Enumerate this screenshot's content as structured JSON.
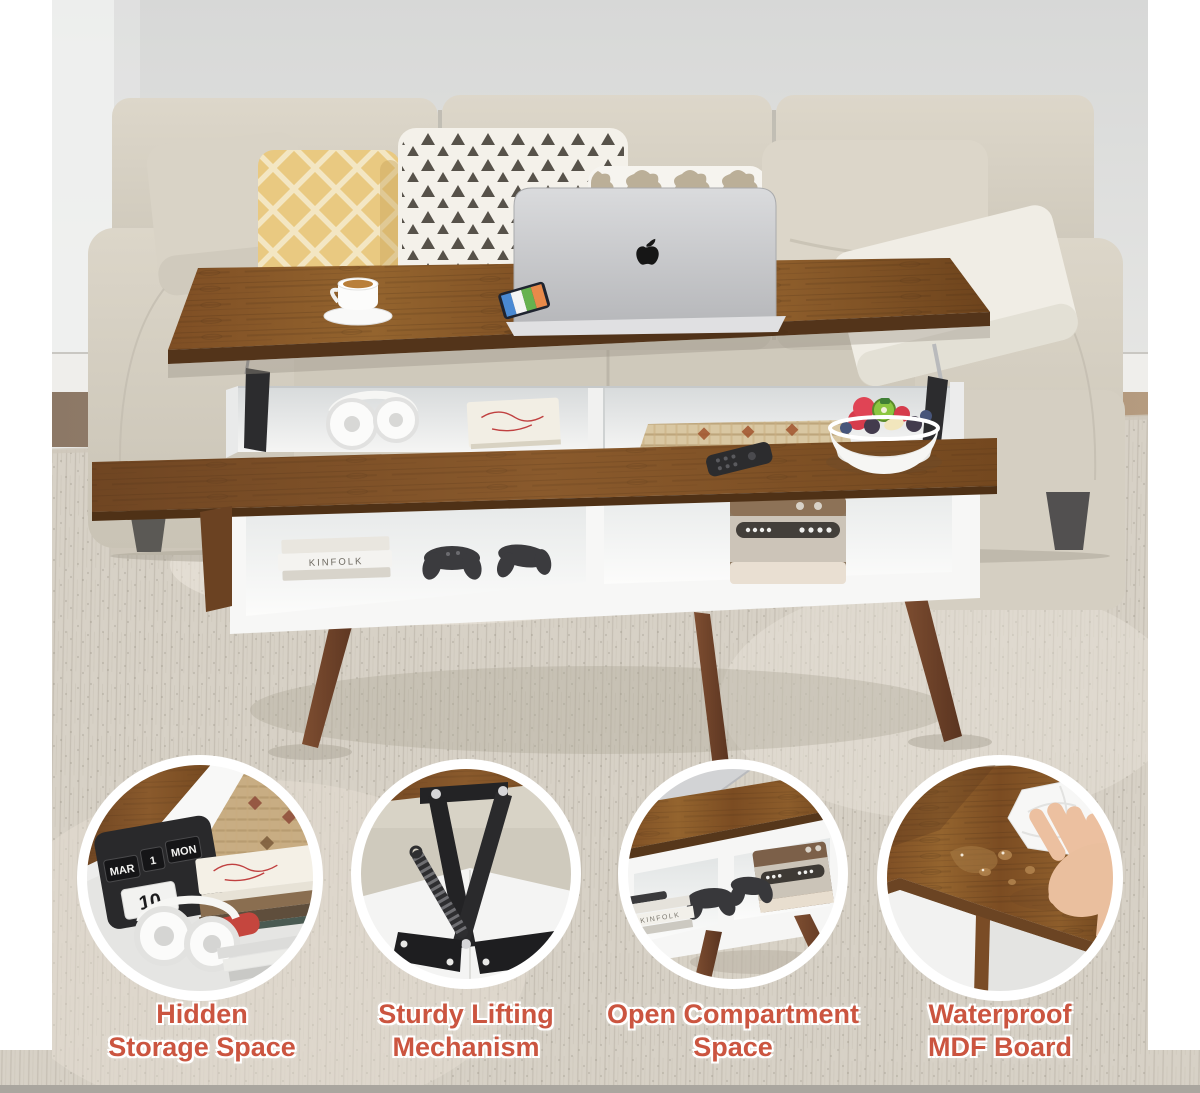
{
  "canvas": {
    "background": "#ffffff",
    "bottom_bar_color": "#aaa69f"
  },
  "accent_color": "#cb5540",
  "captions": [
    {
      "id": "hidden-storage",
      "line1": "Hidden",
      "line2": "Storage Space"
    },
    {
      "id": "lifting-mechanism",
      "line1": "Sturdy Lifting",
      "line2": "Mechanism"
    },
    {
      "id": "open-compartment",
      "line1": "Open Compartment",
      "line2": "Space"
    },
    {
      "id": "waterproof",
      "line1": "Waterproof",
      "line2": "MDF Board"
    }
  ],
  "scene_text": {
    "book_spine": "KINFOLK",
    "flip_calendar": {
      "month": "MAR",
      "date": "1",
      "day": "MON",
      "big_date": "10"
    }
  },
  "icons": {
    "laptop_logo": "apple-logo"
  }
}
